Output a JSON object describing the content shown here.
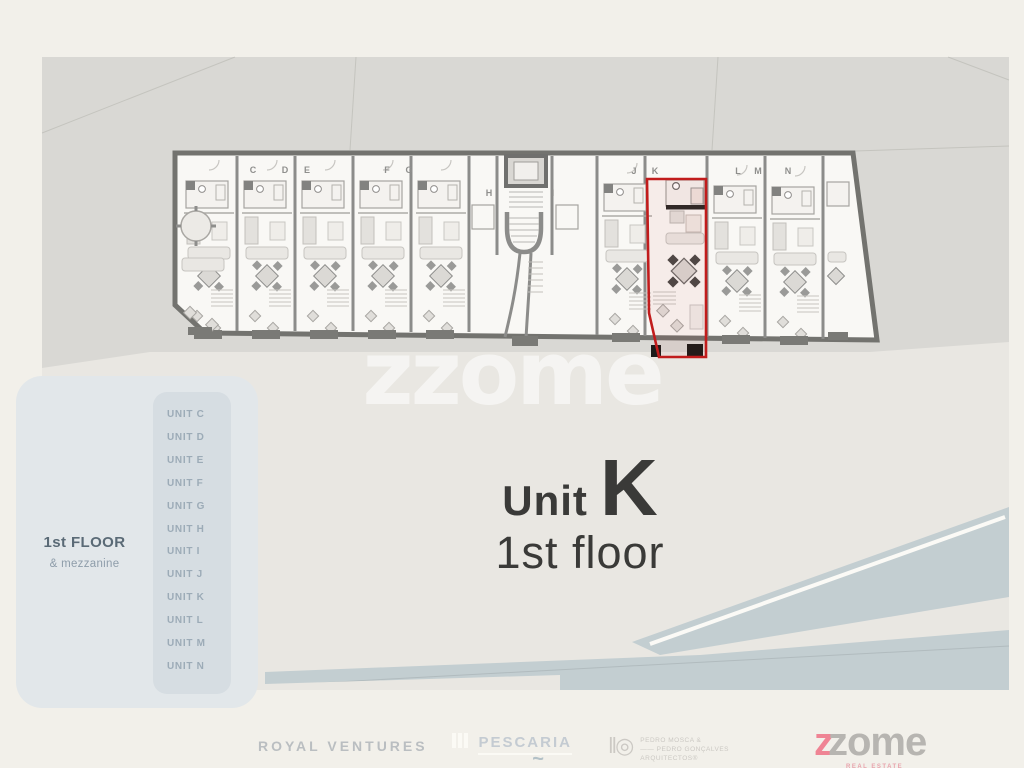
{
  "page": {
    "background": "#f2f0ea"
  },
  "site_plan": {
    "watermark": "zzome",
    "unit_letters": [
      "C",
      "D",
      "E",
      "F",
      "G",
      "H",
      "I",
      "J",
      "K",
      "L",
      "M",
      "N"
    ],
    "highlighted_unit": "K",
    "colors": {
      "site_bg": "#d9d8d4",
      "plaza": "#e9e7e2",
      "water": "#c3ced1",
      "plan_fill": "#f9f8f5",
      "outer_wall": "#73736f",
      "inner_wall": "#8c8c8a",
      "highlight_red": "#c11c1c"
    }
  },
  "sidebar": {
    "floor_label": "1st FLOOR",
    "floor_sublabel": "& mezzanine",
    "units": [
      "UNIT C",
      "UNIT D",
      "UNIT E",
      "UNIT F",
      "UNIT G",
      "UNIT H",
      "UNIT I",
      "UNIT J",
      "UNIT K",
      "UNIT L",
      "UNIT M",
      "UNIT N"
    ]
  },
  "main_label": {
    "unit_prefix": "Unit",
    "unit_letter": "K",
    "floor": "1st floor"
  },
  "footer": {
    "royal_ventures": "ROYAL VENTURES",
    "pescaria": "PESCARIA",
    "pescaria_tilde": "~",
    "architects_glyph": "‖◎",
    "architects_line1": "PEDRO MOSCA &",
    "architects_line2": "—— PEDRO GONÇALVES",
    "architects_line3": "ARQUITECTOS®",
    "zome_z": "z",
    "zome_rest": "zome",
    "zome_sub": "REAL ESTATE"
  }
}
